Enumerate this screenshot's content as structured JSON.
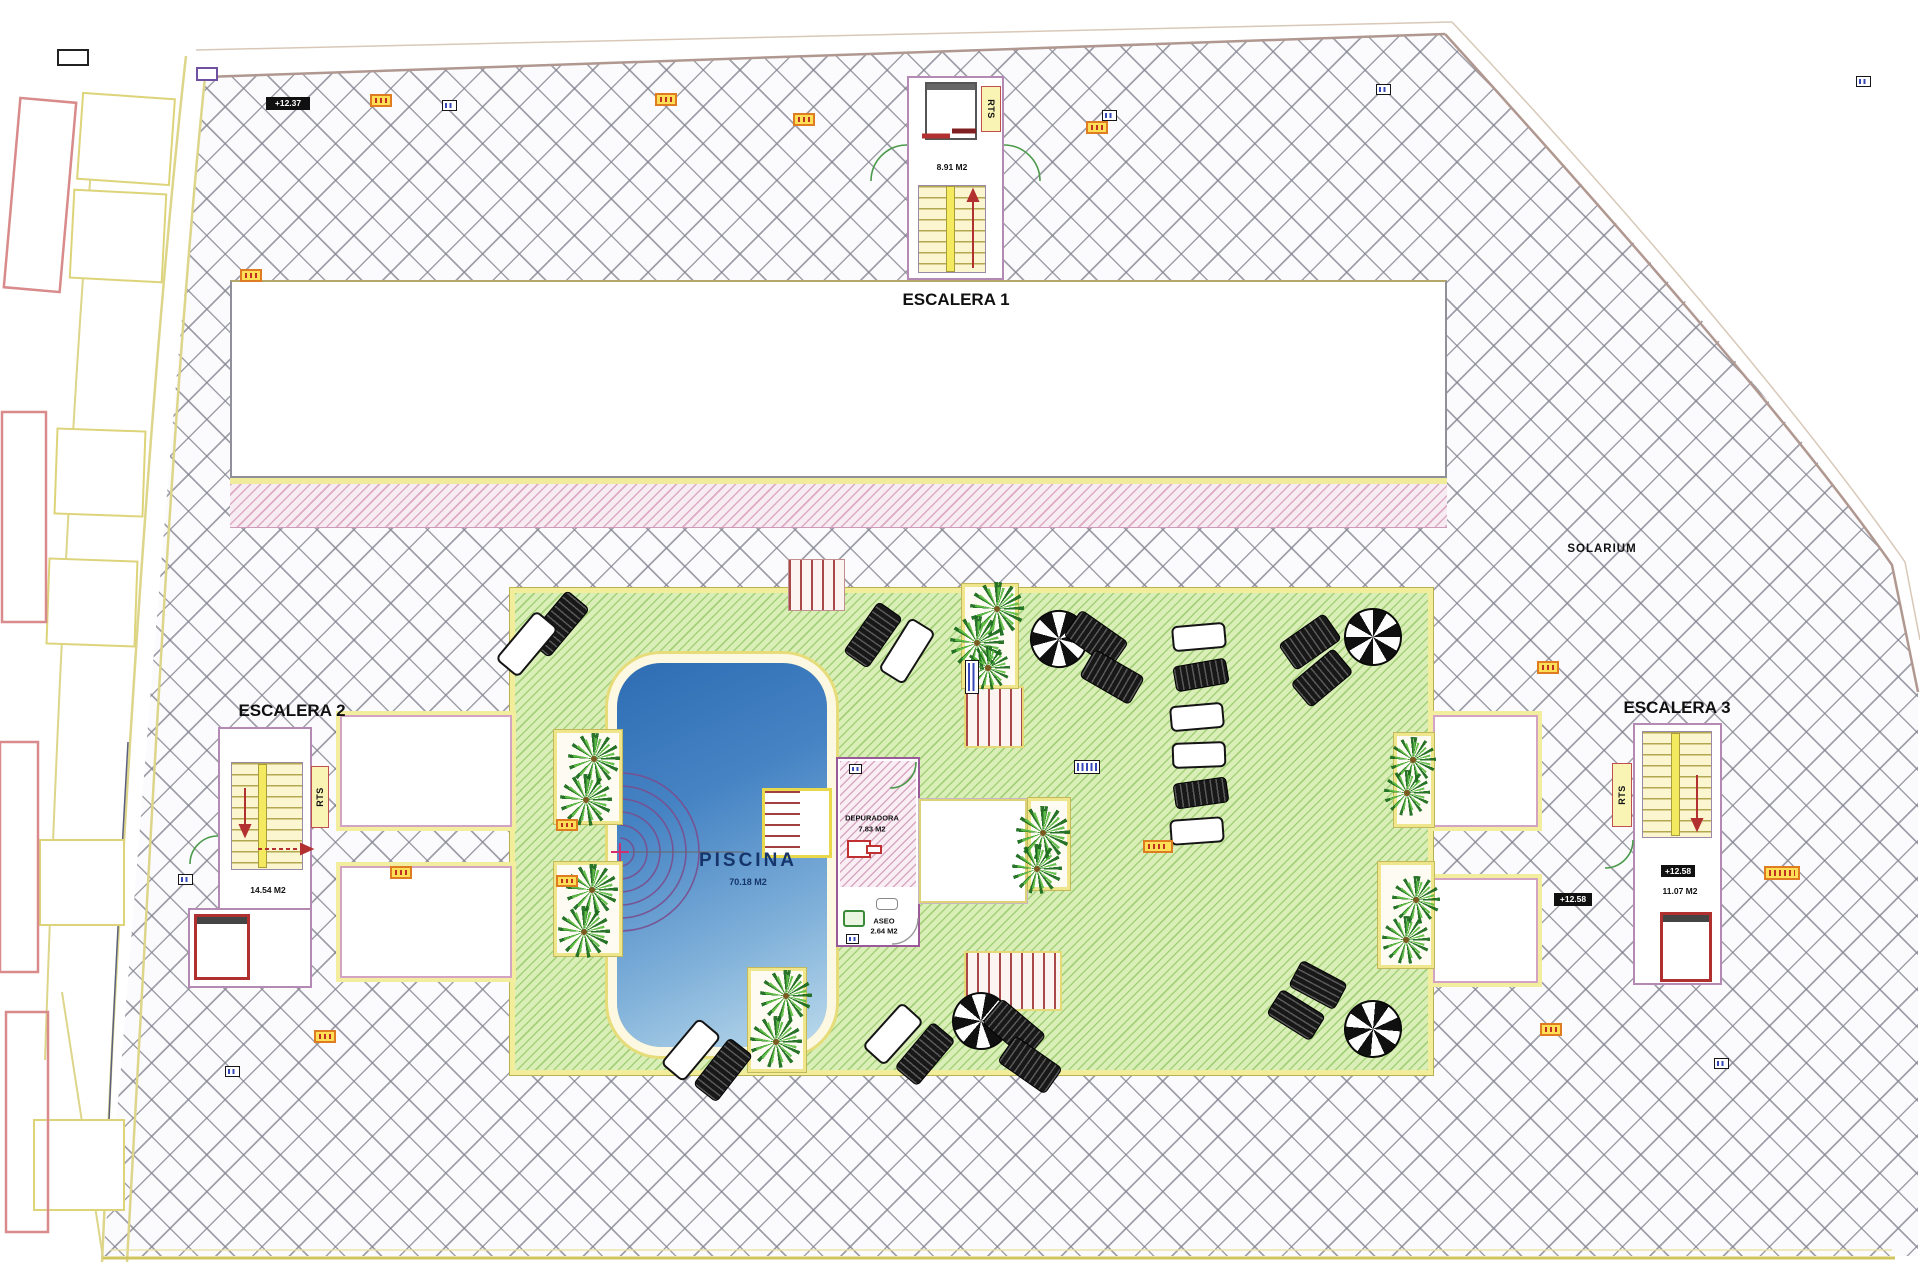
{
  "labels": {
    "escalera1": "ESCALERA 1",
    "escalera2": "ESCALERA 2",
    "escalera3": "ESCALERA 3",
    "solarium": "SOLARIUM",
    "piscina": "PISCINA",
    "piscina_area": "70.18 M2",
    "escalera1_area": "8.91 M2",
    "escalera2_area": "14.54 M2",
    "escalera3_area": "11.07 M2",
    "depuradora": "DEPURADORA",
    "depuradora_area": "7.83 M2",
    "aseo": "ASEO",
    "aseo_area": "2.64 M2",
    "rts": "RTS",
    "level_top_left": "+12.37",
    "level_right": "+12.58",
    "level_escalera3": "+12.58"
  },
  "colors": {
    "deck_green": "#daefb7",
    "hatch_line": "#82828e",
    "pool_blue_dark": "#2f6db4",
    "pool_blue_light": "#bcdaec",
    "accent_yellow": "#f1ed9b",
    "accent_red": "#b03030",
    "wall_pink": "#b48ab4",
    "marker_orange": "#df7b20"
  },
  "decor": [
    {
      "kind": "planter",
      "x": 554,
      "y": 730,
      "w": 68,
      "h": 94
    },
    {
      "kind": "planter",
      "x": 554,
      "y": 862,
      "w": 68,
      "h": 94
    },
    {
      "kind": "planter",
      "x": 962,
      "y": 584,
      "w": 56,
      "h": 104
    },
    {
      "kind": "planter",
      "x": 1028,
      "y": 798,
      "w": 42,
      "h": 92
    },
    {
      "kind": "planter",
      "x": 1394,
      "y": 733,
      "w": 40,
      "h": 94
    },
    {
      "kind": "planter",
      "x": 1378,
      "y": 862,
      "w": 56,
      "h": 106
    },
    {
      "kind": "planter",
      "x": 748,
      "y": 968,
      "w": 58,
      "h": 104
    },
    {
      "kind": "palm",
      "x": 568,
      "y": 733,
      "w": 52,
      "h": 52
    },
    {
      "kind": "palm",
      "x": 560,
      "y": 774,
      "w": 52,
      "h": 52
    },
    {
      "kind": "palm",
      "x": 566,
      "y": 864,
      "w": 52,
      "h": 52
    },
    {
      "kind": "palm",
      "x": 558,
      "y": 906,
      "w": 52,
      "h": 52
    },
    {
      "kind": "palm",
      "x": 970,
      "y": 582,
      "w": 54,
      "h": 54
    },
    {
      "kind": "palm",
      "x": 950,
      "y": 616,
      "w": 54,
      "h": 54
    },
    {
      "kind": "palm",
      "x": 966,
      "y": 646,
      "w": 44,
      "h": 44
    },
    {
      "kind": "palm",
      "x": 1016,
      "y": 806,
      "w": 54,
      "h": 54
    },
    {
      "kind": "palm",
      "x": 1012,
      "y": 844,
      "w": 50,
      "h": 50
    },
    {
      "kind": "palm",
      "x": 1390,
      "y": 737,
      "w": 46,
      "h": 46
    },
    {
      "kind": "palm",
      "x": 1384,
      "y": 770,
      "w": 46,
      "h": 46
    },
    {
      "kind": "palm",
      "x": 1392,
      "y": 876,
      "w": 48,
      "h": 48
    },
    {
      "kind": "palm",
      "x": 1382,
      "y": 916,
      "w": 48,
      "h": 48
    },
    {
      "kind": "palm",
      "x": 760,
      "y": 970,
      "w": 52,
      "h": 52
    },
    {
      "kind": "palm",
      "x": 750,
      "y": 1016,
      "w": 52,
      "h": 52
    },
    {
      "kind": "umbrella",
      "x": 1030,
      "y": 610,
      "w": 58,
      "h": 58,
      "rot": 15
    },
    {
      "kind": "umbrella",
      "x": 1344,
      "y": 608,
      "w": 58,
      "h": 58
    },
    {
      "kind": "umbrella",
      "x": 952,
      "y": 992,
      "w": 58,
      "h": 58,
      "rot": 10
    },
    {
      "kind": "umbrella",
      "x": 1344,
      "y": 1000,
      "w": 58,
      "h": 58,
      "rot": 5
    },
    {
      "kind": "lounger-dark",
      "x": 543,
      "y": 592,
      "w": 30,
      "h": 64,
      "rot": 40
    },
    {
      "kind": "lounger-white",
      "x": 512,
      "y": 612,
      "w": 30,
      "h": 64,
      "rot": 40
    },
    {
      "kind": "lounger-dark",
      "x": 858,
      "y": 604,
      "w": 30,
      "h": 62,
      "rot": 35
    },
    {
      "kind": "lounger-white",
      "x": 892,
      "y": 620,
      "w": 30,
      "h": 62,
      "rot": 32
    },
    {
      "kind": "lounger-dark",
      "x": 1080,
      "y": 610,
      "w": 32,
      "h": 58,
      "rot": -55
    },
    {
      "kind": "lounger-dark",
      "x": 1096,
      "y": 648,
      "w": 32,
      "h": 58,
      "rot": -60
    },
    {
      "kind": "lounger-dark",
      "x": 1294,
      "y": 614,
      "w": 32,
      "h": 56,
      "rot": 55
    },
    {
      "kind": "lounger-dark",
      "x": 1306,
      "y": 650,
      "w": 32,
      "h": 56,
      "rot": 50
    },
    {
      "kind": "lounger-white",
      "x": 1186,
      "y": 610,
      "w": 26,
      "h": 54,
      "rot": 85
    },
    {
      "kind": "lounger-dark",
      "x": 1188,
      "y": 648,
      "w": 26,
      "h": 54,
      "rot": 80
    },
    {
      "kind": "lounger-white",
      "x": 1184,
      "y": 690,
      "w": 26,
      "h": 54,
      "rot": 85
    },
    {
      "kind": "lounger-white",
      "x": 1186,
      "y": 728,
      "w": 26,
      "h": 54,
      "rot": 88
    },
    {
      "kind": "lounger-dark",
      "x": 1188,
      "y": 766,
      "w": 26,
      "h": 54,
      "rot": 82
    },
    {
      "kind": "lounger-white",
      "x": 1184,
      "y": 804,
      "w": 26,
      "h": 54,
      "rot": 86
    },
    {
      "kind": "lounger-white",
      "x": 676,
      "y": 1020,
      "w": 30,
      "h": 60,
      "rot": 40
    },
    {
      "kind": "lounger-dark",
      "x": 708,
      "y": 1040,
      "w": 30,
      "h": 60,
      "rot": 38
    },
    {
      "kind": "lounger-white",
      "x": 878,
      "y": 1004,
      "w": 30,
      "h": 60,
      "rot": 42
    },
    {
      "kind": "lounger-dark",
      "x": 910,
      "y": 1024,
      "w": 30,
      "h": 60,
      "rot": 40
    },
    {
      "kind": "lounger-dark",
      "x": 998,
      "y": 1000,
      "w": 32,
      "h": 58,
      "rot": -50
    },
    {
      "kind": "lounger-dark",
      "x": 1014,
      "y": 1036,
      "w": 32,
      "h": 58,
      "rot": -55
    },
    {
      "kind": "lounger-dark",
      "x": 1292,
      "y": 970,
      "w": 52,
      "h": 30,
      "rot": 28
    },
    {
      "kind": "lounger-dark",
      "x": 1270,
      "y": 1000,
      "w": 52,
      "h": 30,
      "rot": 32
    },
    {
      "kind": "tag-orange",
      "x": 370,
      "y": 94,
      "w": 22,
      "h": 13
    },
    {
      "kind": "tag-orange",
      "x": 655,
      "y": 93,
      "w": 22,
      "h": 13
    },
    {
      "kind": "tag-orange",
      "x": 793,
      "y": 113,
      "w": 22,
      "h": 13
    },
    {
      "kind": "tag-orange",
      "x": 1086,
      "y": 121,
      "w": 22,
      "h": 13
    },
    {
      "kind": "tag-orange",
      "x": 240,
      "y": 269,
      "w": 22,
      "h": 13
    },
    {
      "kind": "tag-orange",
      "x": 556,
      "y": 819,
      "w": 22,
      "h": 12
    },
    {
      "kind": "tag-orange",
      "x": 556,
      "y": 875,
      "w": 22,
      "h": 12
    },
    {
      "kind": "tag-orange",
      "x": 390,
      "y": 866,
      "w": 22,
      "h": 13
    },
    {
      "kind": "tag-orange",
      "x": 1143,
      "y": 840,
      "w": 30,
      "h": 13
    },
    {
      "kind": "tag-orange",
      "x": 1537,
      "y": 661,
      "w": 22,
      "h": 13
    },
    {
      "kind": "tag-orange",
      "x": 1764,
      "y": 866,
      "w": 36,
      "h": 14
    },
    {
      "kind": "tag-orange",
      "x": 1540,
      "y": 1023,
      "w": 22,
      "h": 13
    },
    {
      "kind": "tag-orange",
      "x": 314,
      "y": 1030,
      "w": 22,
      "h": 13
    },
    {
      "kind": "tag-blue",
      "x": 442,
      "y": 100,
      "w": 15,
      "h": 11
    },
    {
      "kind": "tag-blue",
      "x": 1102,
      "y": 110,
      "w": 15,
      "h": 11
    },
    {
      "kind": "tag-blue",
      "x": 1376,
      "y": 84,
      "w": 15,
      "h": 11
    },
    {
      "kind": "tag-blue",
      "x": 1856,
      "y": 76,
      "w": 15,
      "h": 11
    },
    {
      "kind": "tag-blue",
      "x": 178,
      "y": 874,
      "w": 15,
      "h": 11
    },
    {
      "kind": "tag-blue",
      "x": 225,
      "y": 1066,
      "w": 15,
      "h": 11
    },
    {
      "kind": "tag-blue",
      "x": 1714,
      "y": 1058,
      "w": 15,
      "h": 11
    },
    {
      "kind": "tag-blue",
      "x": 849,
      "y": 764,
      "w": 13,
      "h": 10
    },
    {
      "kind": "tag-blue",
      "x": 846,
      "y": 934,
      "w": 13,
      "h": 10
    },
    {
      "kind": "tag-blue",
      "x": 1074,
      "y": 760,
      "w": 26,
      "h": 14
    },
    {
      "kind": "tag-blue",
      "x": 965,
      "y": 660,
      "w": 14,
      "h": 34
    }
  ]
}
